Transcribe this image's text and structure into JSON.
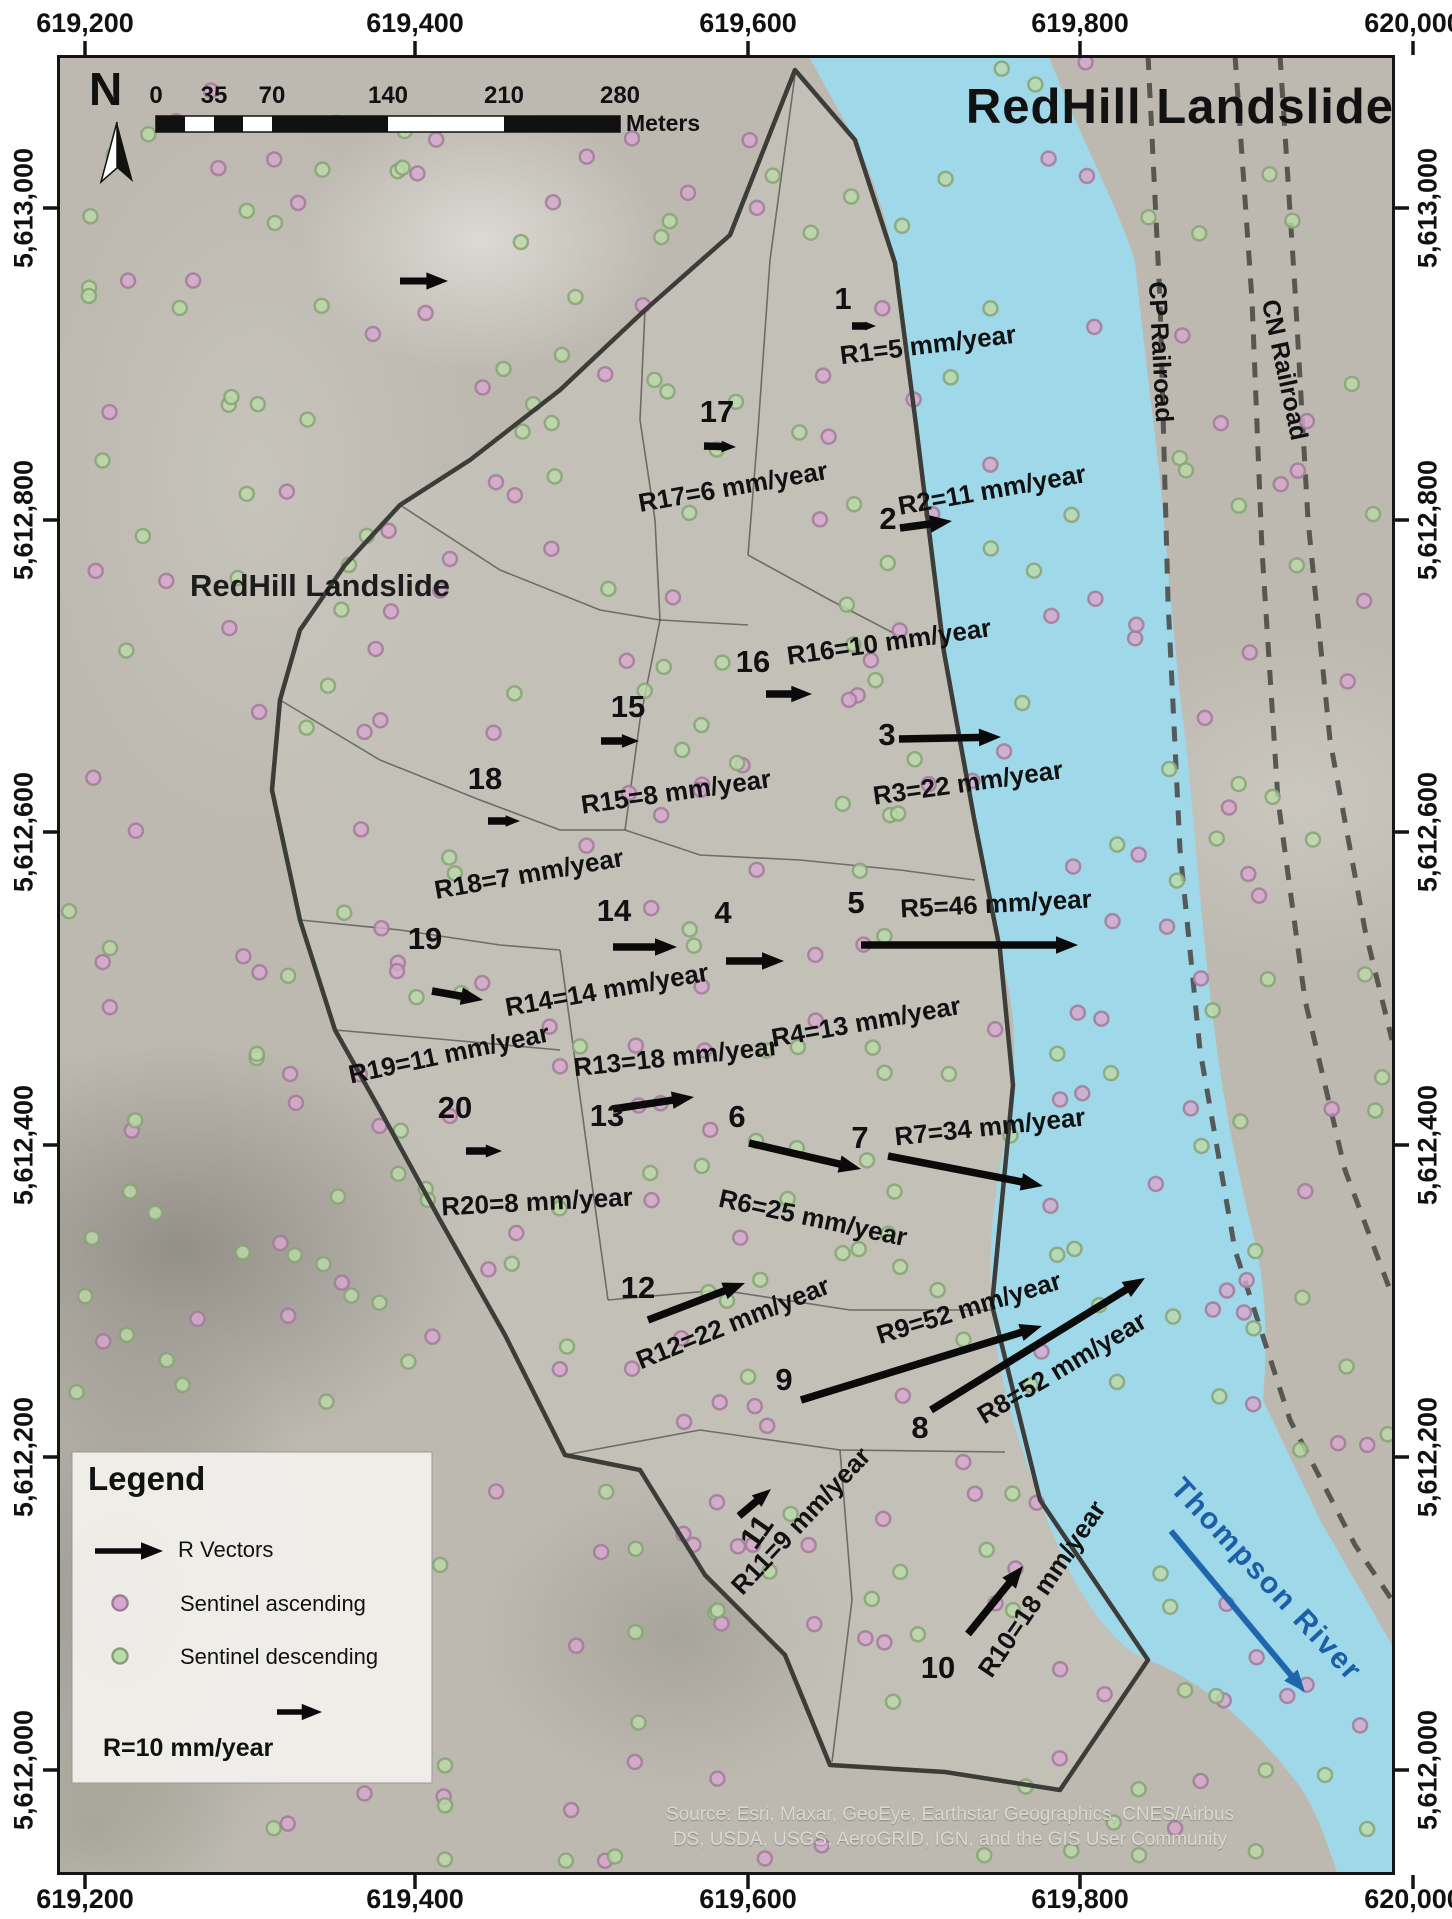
{
  "title": "RedHill Landslide",
  "map_label": "RedHill Landslide",
  "north_label": "N",
  "axes": {
    "x_labels": [
      "619,200",
      "619,400",
      "619,600",
      "619,800",
      "620,000"
    ],
    "x_pos": [
      85,
      415,
      748,
      1080,
      1413
    ],
    "y_labels": [
      "5,613,000",
      "5,612,800",
      "5,612,600",
      "5,612,400",
      "5,612,200",
      "5,612,000"
    ],
    "y_pos": [
      208,
      520,
      832,
      1145,
      1457,
      1770
    ]
  },
  "scalebar": {
    "tick_labels": [
      "0",
      "35",
      "70",
      "140",
      "210",
      "280"
    ],
    "tick_x": [
      156,
      214,
      272,
      388,
      504,
      620
    ],
    "unit": "Meters",
    "bar_y": 116,
    "bar_h": 16,
    "black_segments": [
      [
        156,
        29
      ],
      [
        214,
        29
      ],
      [
        272,
        116
      ],
      [
        504,
        116
      ]
    ]
  },
  "legend": {
    "title": "Legend",
    "vector_label": "R Vectors",
    "ascending_label": "Sentinel ascending",
    "descending_label": "Sentinel descending",
    "reference_label": "R=10 mm/year",
    "box": [
      72,
      1452,
      360,
      331
    ]
  },
  "railroads": {
    "cp_label": "CP Railroad",
    "cn_label": "CN Railroad"
  },
  "river_label": "Thompson River",
  "source_line1": "Source: Esri, Maxar, GeoEye, Earthstar Geographics, CNES/Airbus",
  "source_line2": "DS, USDA, USGS, AeroGRID, IGN, and the GIS User Community",
  "colors": {
    "water": "#9fd8e9",
    "terrain": "#bdb9b1",
    "landslide_fill": "#c9c6bd",
    "boundary": "#3c3c38",
    "interior_line": "#50504b",
    "railroad": "#45443f",
    "vector": "#0a0a0a",
    "river_text": "#1a5fa8",
    "ascending_fill": "#d7a8ce",
    "ascending_stroke": "#a17b98",
    "descending_fill": "#bcd9a9",
    "descending_stroke": "#87a376"
  },
  "points": {
    "seed": 42,
    "count": 430
  },
  "vectors": [
    {
      "zone": "1",
      "rate_mm_yr": 5,
      "label": "R1=5 mm/year",
      "nx": 843,
      "ny": 299,
      "ax": 852,
      "ay": 326,
      "bx": 876,
      "by": 326,
      "tx": 928,
      "ty": 345,
      "tr": -7
    },
    {
      "zone": "2",
      "rate_mm_yr": 11,
      "label": "R2=11 mm/year",
      "nx": 888,
      "ny": 519,
      "ax": 900,
      "ay": 528,
      "bx": 952,
      "by": 521,
      "tx": 992,
      "ty": 490,
      "tr": -10
    },
    {
      "zone": "3",
      "rate_mm_yr": 22,
      "label": "R3=22 mm/year",
      "nx": 887,
      "ny": 735,
      "ax": 899,
      "ay": 739,
      "bx": 1001,
      "by": 737,
      "tx": 968,
      "ty": 783,
      "tr": -8
    },
    {
      "zone": "4",
      "rate_mm_yr": 13,
      "label": "R4=13 mm/year",
      "nx": 723,
      "ny": 913,
      "ax": 726,
      "ay": 961,
      "bx": 784,
      "by": 961,
      "tx": 866,
      "ty": 1022,
      "tr": -10
    },
    {
      "zone": "5",
      "rate_mm_yr": 46,
      "label": "R5=46 mm/year",
      "nx": 856,
      "ny": 903,
      "ax": 861,
      "ay": 945,
      "bx": 1078,
      "by": 945,
      "tx": 996,
      "ty": 904,
      "tr": -3
    },
    {
      "zone": "6",
      "rate_mm_yr": 25,
      "label": "R6=25 mm/year",
      "nx": 737,
      "ny": 1117,
      "ax": 749,
      "ay": 1143,
      "bx": 861,
      "by": 1169,
      "tx": 813,
      "ty": 1218,
      "tr": 12
    },
    {
      "zone": "7",
      "rate_mm_yr": 34,
      "label": "R7=34 mm/year",
      "nx": 860,
      "ny": 1138,
      "ax": 888,
      "ay": 1156,
      "bx": 1043,
      "by": 1186,
      "tx": 990,
      "ty": 1127,
      "tr": -6
    },
    {
      "zone": "8",
      "rate_mm_yr": 52,
      "label": "R8=52 mm/year",
      "nx": 920,
      "ny": 1428,
      "ax": 931,
      "ay": 1410,
      "bx": 1145,
      "by": 1278,
      "tx": 1062,
      "ty": 1368,
      "tr": -31
    },
    {
      "zone": "9",
      "rate_mm_yr": 52,
      "label": "R9=52 mm/year",
      "nx": 784,
      "ny": 1380,
      "ax": 801,
      "ay": 1400,
      "bx": 1042,
      "by": 1326,
      "tx": 969,
      "ty": 1308,
      "tr": -17
    },
    {
      "zone": "10",
      "rate_mm_yr": 18,
      "label": "R10=18 mm/year",
      "nx": 938,
      "ny": 1668,
      "ax": 968,
      "ay": 1634,
      "bx": 1023,
      "by": 1566,
      "tx": 1042,
      "ty": 1589,
      "tr": -56
    },
    {
      "zone": "11",
      "rate_mm_yr": 9,
      "label": "R11=9 mm/year",
      "nx": 757,
      "ny": 1532,
      "nr": -55,
      "ax": 739,
      "ay": 1516,
      "bx": 771,
      "by": 1489,
      "tx": 801,
      "ty": 1521,
      "tr": -47
    },
    {
      "zone": "12",
      "rate_mm_yr": 22,
      "label": "R12=22 mm/year",
      "nx": 638,
      "ny": 1288,
      "ax": 648,
      "ay": 1320,
      "bx": 745,
      "by": 1283,
      "tx": 733,
      "ty": 1323,
      "tr": -22
    },
    {
      "zone": "13",
      "rate_mm_yr": 18,
      "label": "R13=18 mm/year",
      "nx": 607,
      "ny": 1116,
      "ax": 613,
      "ay": 1109,
      "bx": 694,
      "by": 1097,
      "tx": 676,
      "ty": 1057,
      "tr": -6
    },
    {
      "zone": "14",
      "rate_mm_yr": 14,
      "label": "R14=14 mm/year",
      "nx": 614,
      "ny": 911,
      "ax": 613,
      "ay": 947,
      "bx": 677,
      "by": 947,
      "tx": 607,
      "ty": 990,
      "tr": -10
    },
    {
      "zone": "15",
      "rate_mm_yr": 8,
      "label": "R15=8 mm/year",
      "nx": 628,
      "ny": 707,
      "ax": 601,
      "ay": 741,
      "bx": 639,
      "by": 741,
      "tx": 676,
      "ty": 792,
      "tr": -8
    },
    {
      "zone": "16",
      "rate_mm_yr": 10,
      "label": "R16=10 mm/year",
      "nx": 753,
      "ny": 662,
      "ax": 766,
      "ay": 694,
      "bx": 812,
      "by": 694,
      "tx": 889,
      "ty": 642,
      "tr": -8
    },
    {
      "zone": "17",
      "rate_mm_yr": 6,
      "label": "R17=6 mm/year",
      "nx": 717,
      "ny": 412,
      "ax": 704,
      "ay": 446,
      "bx": 736,
      "by": 447,
      "tx": 733,
      "ty": 487,
      "tr": -10
    },
    {
      "zone": "18",
      "rate_mm_yr": 7,
      "label": "R18=7 mm/year",
      "nx": 485,
      "ny": 779,
      "ax": 488,
      "ay": 821,
      "bx": 520,
      "by": 821,
      "tx": 529,
      "ty": 874,
      "tr": -10
    },
    {
      "zone": "19",
      "rate_mm_yr": 11,
      "label": "R19=11 mm/year",
      "nx": 425,
      "ny": 939,
      "ax": 432,
      "ay": 991,
      "bx": 483,
      "by": 1000,
      "tx": 449,
      "ty": 1054,
      "tr": -12
    },
    {
      "zone": "20",
      "rate_mm_yr": 8,
      "label": "R20=8 mm/year",
      "nx": 455,
      "ny": 1108,
      "ax": 466,
      "ay": 1151,
      "bx": 502,
      "by": 1151,
      "tx": 537,
      "ty": 1202,
      "tr": -3
    }
  ],
  "geometry": {
    "frame": [
      57,
      55,
      1338,
      1820
    ],
    "stray_arrow": {
      "ax": 400,
      "ay": 281,
      "bx": 448,
      "by": 281
    },
    "river_arrow": {
      "ax": 1171,
      "ay": 1531,
      "bx": 1305,
      "by": 1692
    },
    "river_path": "M808,55 L1048,55 C1090,160 1120,210 1135,262 C1150,400 1155,430 1162,500 C1175,650 1180,700 1188,760 C1200,900 1205,950 1212,1010 C1225,1120 1240,1180 1258,1255 C1268,1310 1266,1360 1263,1400 L1320,1520 L1392,1645 L1392,1875 L1338,1875 C1320,1820 1310,1800 1295,1780 C1250,1722 1200,1680 1148,1660 C1100,1642 1060,1560 1040,1500 C1010,1420 995,1360 992,1305 C985,1200 1008,1150 1013,1085 C1018,1010 1005,975 1000,950 C990,880 982,850 974,818 C962,760 950,705 944,652 C932,570 922,490 916,425 C908,360 903,310 895,263 C885,210 870,170 855,140 Z",
    "boundary": "795,70 730,235 645,310 560,390 470,460 400,505 345,565 300,630 280,700 272,790 300,920 335,1030 380,1110 440,1220 505,1335 565,1455 640,1470 705,1575 785,1655 830,1765 945,1772 1060,1790 1148,1660 1040,1500 992,1305 1013,1085 1000,950 974,818 944,652 916,425 895,263 855,140",
    "interior_lines": [
      "795,75 770,260 758,430 748,555",
      "748,555 830,600 903,638",
      "645,310 640,420 655,520 660,620 640,720 625,830",
      "400,505 500,570 600,610 660,620",
      "660,620 748,625",
      "280,700 380,760 480,800 560,830 625,830",
      "625,830 700,855 800,860 900,870 975,880",
      "300,920 400,930 500,945 560,950",
      "560,950 575,1060 590,1170 608,1300",
      "608,1300 720,1290 850,1310 992,1310",
      "565,1455 700,1430 840,1450 1005,1452",
      "840,1450 852,1600 832,1762",
      "335,1030 450,1040 560,1050"
    ],
    "railroads": [
      "1148,55 1160,300 1168,600 1180,850 1200,1050 1235,1250 1290,1420 1355,1545 1392,1600",
      "1235,55 1252,300 1262,550 1278,800 1305,1000 1345,1170 1390,1290",
      "1280,55 1295,290 1308,520 1330,740 1365,930 1392,1040"
    ],
    "north_arrow": {
      "left": [
        [
          117,
          122
        ],
        [
          101,
          182
        ],
        [
          117,
          168
        ]
      ],
      "right": [
        [
          117,
          122
        ],
        [
          133,
          182
        ],
        [
          117,
          168
        ]
      ]
    },
    "legend_arrow1": {
      "ax": 95,
      "ay": 1551,
      "bx": 163,
      "by": 1551
    },
    "legend_arrow2": {
      "ax": 277,
      "ay": 1712,
      "bx": 322,
      "by": 1712
    },
    "legend_dot1": {
      "x": 120,
      "y": 1603
    },
    "legend_dot2": {
      "x": 120,
      "y": 1656
    }
  }
}
